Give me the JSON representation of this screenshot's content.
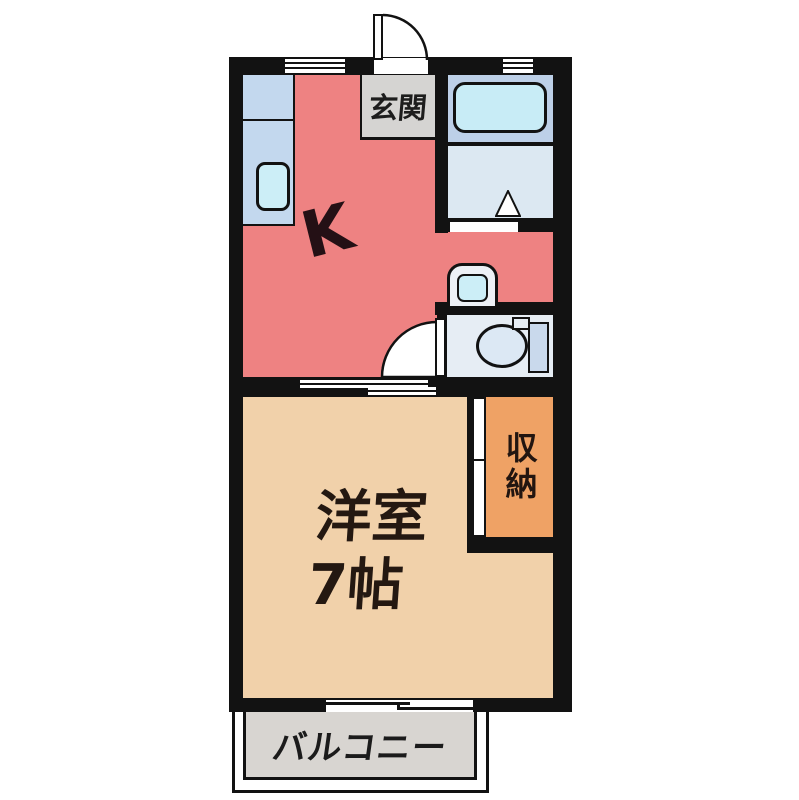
{
  "page": {
    "type": "apartment-floor-plan",
    "background": "#ffffff"
  },
  "rooms": {
    "kitchen": {
      "label": "K",
      "color": "#ee8282"
    },
    "entrance": {
      "label": "玄関",
      "color": "#d5d4d2"
    },
    "bathroom": {
      "color": "#bdd0e8",
      "tub_color": "#c8ecf6"
    },
    "washroom": {
      "color": "#dce8f2"
    },
    "toilet_room": {
      "color": "#e6edf4"
    },
    "western_room": {
      "label": "洋室",
      "size_label": "7帖",
      "color": "#f1d1aa"
    },
    "storage": {
      "label": "収納",
      "color": "#efa265"
    },
    "balcony": {
      "label": "バルコニー",
      "color": "#d8d5d1"
    }
  },
  "fixtures": [
    "kitchen-counter",
    "kitchen-sink",
    "bathtub",
    "washbasin",
    "toilet",
    "entrance-door",
    "toilet-door",
    "sliding-door",
    "sliding-window",
    "storage-door"
  ],
  "palette": {
    "wall": "#121212",
    "window": "#ffffff",
    "counter": "#c3d8ee",
    "sink": "#cceef7",
    "text": "#221510"
  }
}
